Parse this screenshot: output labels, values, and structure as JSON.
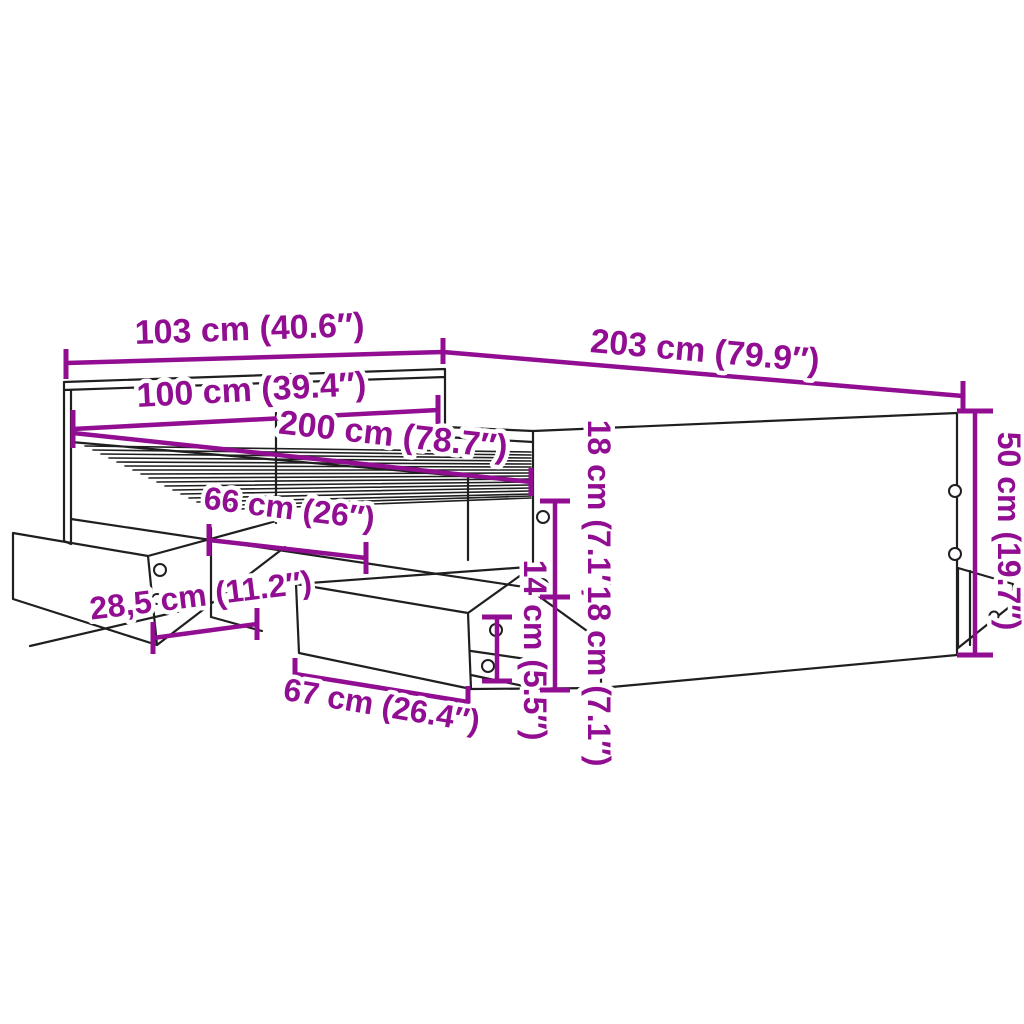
{
  "diagram": {
    "background_color": "#ffffff",
    "line_color": "#1f1f1f",
    "dimension_color": "#910D91",
    "dimensions": {
      "overall_width": "103 cm (40.6″)",
      "overall_length": "203 cm (79.9″)",
      "inner_width": "100 cm (39.4″)",
      "inner_length": "200 cm (78.7″)",
      "drawer_opening_width": "66 cm (26″)",
      "drawer_extension": "28,5 cm (11.2″)",
      "drawer_front_width": "67 cm (26.4″)",
      "drawer_front_height": "14 cm (5.5″)",
      "rail_height_upper": "18 cm (7.1″)",
      "rail_height_lower": "18 cm (7.1″)",
      "end_panel_height": "50 cm (19.7″)"
    }
  }
}
